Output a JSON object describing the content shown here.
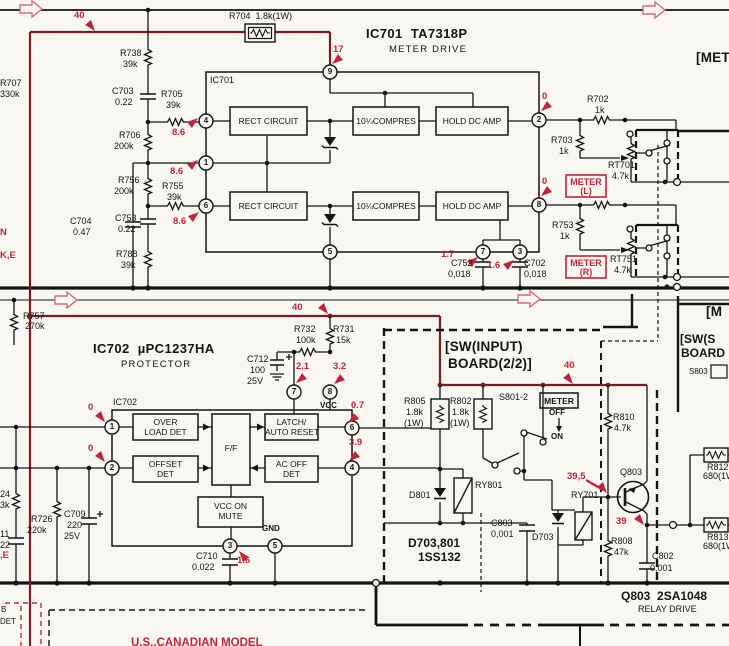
{
  "colors": {
    "ink": "#141414",
    "red": "#c2233a",
    "maroon": "#7a1c24",
    "paper": "#f8f7f2"
  },
  "ic701": {
    "part": "IC701  TA7318P",
    "function": "METER DRIVE",
    "ref": "IC701",
    "rect": "RECT CIRCUIT",
    "compres": "10¼COMPRES",
    "hold": "HOLD DC AMP",
    "pins": {
      "p1": "1",
      "p2": "2",
      "p3": "3",
      "p4": "4",
      "p5": "5",
      "p6": "6",
      "p7": "7",
      "p8": "8",
      "p9": "9"
    }
  },
  "ic702": {
    "part": "IC702  µPC1237HA",
    "function": "PROTECTOR",
    "ref": "IC702",
    "over1": "OVER",
    "over2": "LOAD DET",
    "ff": "F/F",
    "latch1": "LATCH/",
    "latch2": "AUTO RESET",
    "offset1": "OFFSET",
    "offset2": "DET",
    "acoff1": "AC OFF",
    "acoff2": "DET",
    "mute1": "VCC ON",
    "mute2": "MUTE",
    "vcc": "VCC",
    "gnd": "GND",
    "pins": {
      "p1": "1",
      "p2": "2",
      "p3": "3",
      "p4": "4",
      "p5": "5",
      "p6": "6",
      "p7": "7",
      "p8": "8"
    }
  },
  "parts": {
    "r704": {
      "label": "R704  1.8k(1W)"
    },
    "r738": {
      "ref": "R738",
      "val": "39k"
    },
    "r707": {
      "ref": "R707",
      "val": "330k"
    },
    "c703": {
      "ref": "C703",
      "val": "0.22"
    },
    "r705": {
      "ref": "R705",
      "val": "39k"
    },
    "r706": {
      "ref": "R706",
      "val": "200k"
    },
    "r756": {
      "ref": "R756",
      "val": "200k"
    },
    "r755": {
      "ref": "R755",
      "val": "39k"
    },
    "c704": {
      "ref": "C704",
      "val": "0.47"
    },
    "c753": {
      "ref": "C753",
      "val": "0.22"
    },
    "r788": {
      "ref": "R788",
      "val": "39k"
    },
    "r702": {
      "ref": "R702",
      "val": "1k"
    },
    "r703": {
      "ref": "R703",
      "val": "1k"
    },
    "rt701": {
      "ref": "RT701",
      "val": "4.7k"
    },
    "r753": {
      "ref": "R753",
      "val": "1k"
    },
    "rt751": {
      "ref": "RT751",
      "val": "4.7k"
    },
    "c752": {
      "ref": "C752",
      "val": "0,018"
    },
    "c702": {
      "ref": "C702",
      "val": "0,018"
    },
    "r757": {
      "ref": "R757",
      "val": "270k"
    },
    "r732": {
      "ref": "R732",
      "val": "100k"
    },
    "r731": {
      "ref": "R731",
      "val": "15k"
    },
    "c712": {
      "ref": "C712",
      "val": "100",
      "volt": "25V"
    },
    "r726": {
      "ref": "R726",
      "val": "220k"
    },
    "c709": {
      "ref": "C709",
      "val": "220",
      "volt": "25V"
    },
    "c710": {
      "ref": "C710",
      "val": "0.022"
    },
    "r805": {
      "ref": "R805",
      "val": "1.8k",
      "watt": "(1W)"
    },
    "r802": {
      "ref": "R802",
      "val": "1.8k",
      "watt": "(1W)"
    },
    "d801": {
      "ref": "D801"
    },
    "ry801": {
      "ref": "RY801"
    },
    "c803": {
      "ref": "C803",
      "val": "0,001"
    },
    "d703": {
      "ref": "D703"
    },
    "ry701": {
      "ref": "RY701"
    },
    "r810": {
      "ref": "R810",
      "val": "4.7k"
    },
    "q803": {
      "ref": "Q803"
    },
    "r808": {
      "ref": "R808",
      "val": "47k"
    },
    "c802": {
      "ref": "C802",
      "val": "0,001"
    },
    "r812": {
      "ref": "R812",
      "val": "680(1W"
    },
    "r813": {
      "ref": "R813",
      "val": "680(1W"
    }
  },
  "volts": {
    "top40": "40",
    "v17": "17",
    "v86_4": "8.6",
    "v86_1": "8.6",
    "v86_6": "8.6",
    "v0_2": "0",
    "v0_8": "0",
    "v1_7": "1.7",
    "v1_6": "1.6",
    "mid40": "40",
    "v2_1": "2.1",
    "v3_2": "3.2",
    "v0_7": "0.7",
    "v0_p1": "0",
    "v0_p2": "0",
    "v3_9": "3.9",
    "v1_6b": "1.6",
    "sw40": "40",
    "v39_5": "39,5",
    "v39": "39"
  },
  "meter": {
    "l1": "METER",
    "l2": "(L)",
    "r1": "METER",
    "r2": "(R)"
  },
  "sw": {
    "s801": "S801-2",
    "meter": "METER",
    "off": "OFF",
    "on": "ON",
    "s803": "S803"
  },
  "boards": {
    "sw_input_1": "[SW(INPUT)",
    "sw_input_2": "BOARD(2/2)]",
    "met": "[MET",
    "m": "[M",
    "sw_s": "[SW(S",
    "board": "BOARD"
  },
  "notes": {
    "d_refs": "D703,801",
    "d_type": "1SS132",
    "q803_line": "Q803  2SA1048",
    "q803_fn": "RELAY DRIVE",
    "model": "U.S.,CANADIAN MODEL"
  },
  "edge": {
    "n": "N",
    "ke": "K,E",
    "e": ",E",
    "p24": "24",
    "p3k": "3k",
    "p11": "11",
    "p22": "22",
    "b": "B",
    "det": "DET"
  }
}
